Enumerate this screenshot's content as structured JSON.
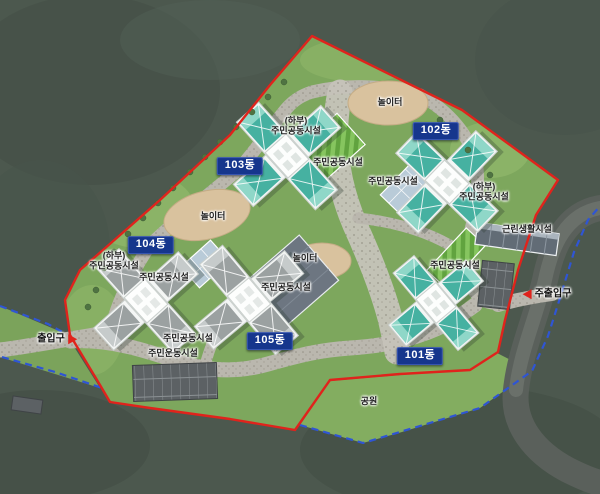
{
  "labels": {
    "buildings": [
      {
        "id": "101",
        "text": "101동"
      },
      {
        "id": "102",
        "text": "102동"
      },
      {
        "id": "103",
        "text": "103동"
      },
      {
        "id": "104",
        "text": "104동"
      },
      {
        "id": "105",
        "text": "105동"
      }
    ],
    "facilities": [
      {
        "text": "(하부)\n주민공동시설"
      },
      {
        "text": "주민공동시설"
      },
      {
        "text": "주민공동시설"
      },
      {
        "text": "(하부)\n주민공동시설"
      },
      {
        "text": "(하부)\n주민공동시설"
      },
      {
        "text": "주민공동시설"
      },
      {
        "text": "주민공동시설"
      },
      {
        "text": "주민공동시설"
      },
      {
        "text": "주민공동시설"
      },
      {
        "text": "주민운동시설"
      }
    ],
    "retail": "근린생활시설",
    "playground": "놀이터",
    "park": "공원",
    "entrance_main": "주출입구",
    "entrance_side": "출입구"
  },
  "colors": {
    "boundary_site": "#e0231c",
    "boundary_district": "#2f55d4",
    "roof_teal": "#46b1a1",
    "roof_gray": "#9ba1a1",
    "building_label_bg": "#16368d",
    "lawn": "#7da75d",
    "forest": "#4c584e",
    "sand": "#d9c29e",
    "road": "#bab7ae"
  }
}
